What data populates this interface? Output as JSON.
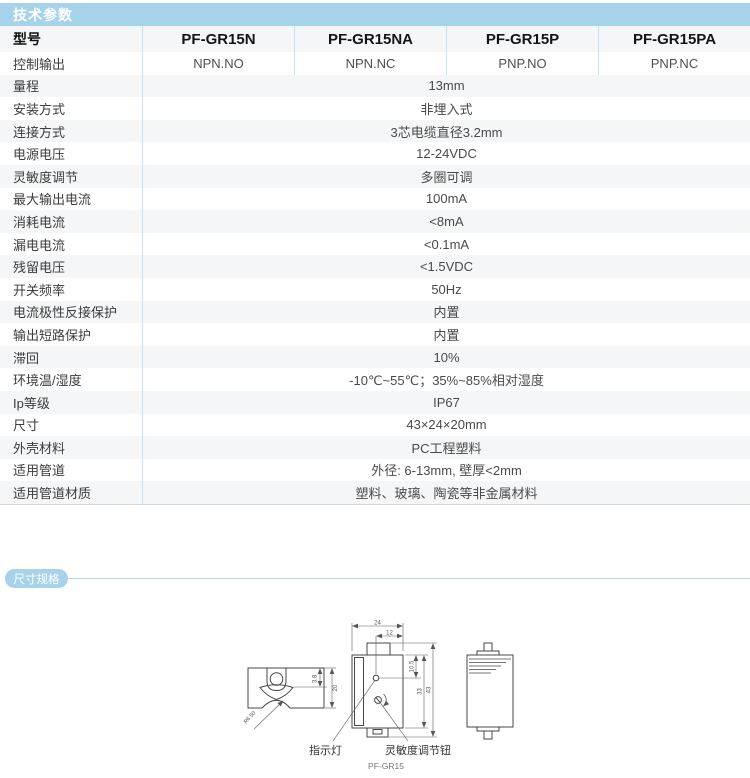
{
  "colors": {
    "accent_blue": "#a6d3e9",
    "divider_blue": "#c9e2f2",
    "stripe_gray": "#f5f6f7"
  },
  "tech": {
    "section_title": "技术参数",
    "model_label": "型号",
    "models": [
      "PF-GR15N",
      "PF-GR15NA",
      "PF-GR15P",
      "PF-GR15PA"
    ],
    "output_row": {
      "label": "控制输出",
      "values": [
        "NPN.NO",
        "NPN.NC",
        "PNP.NO",
        "PNP.NC"
      ]
    },
    "rows": [
      {
        "label": "量程",
        "value": "13mm"
      },
      {
        "label": "安装方式",
        "value": "非埋入式"
      },
      {
        "label": "连接方式",
        "value": "3芯电缆直径3.2mm"
      },
      {
        "label": "电源电压",
        "value": "12-24VDC"
      },
      {
        "label": "灵敏度调节",
        "value": "多圈可调"
      },
      {
        "label": "最大输出电流",
        "value": "100mA"
      },
      {
        "label": "消耗电流",
        "value": "<8mA"
      },
      {
        "label": "漏电电流",
        "value": "<0.1mA"
      },
      {
        "label": "残留电压",
        "value": "<1.5VDC"
      },
      {
        "label": "开关频率",
        "value": "50Hz"
      },
      {
        "label": "电流极性反接保护",
        "value": "内置"
      },
      {
        "label": "输出短路保护",
        "value": "内置"
      },
      {
        "label": "滞回",
        "value": "10%"
      },
      {
        "label": "环境温/湿度",
        "value": "-10℃~55℃；35%~85%相对湿度"
      },
      {
        "label": "Ip等级",
        "value": "IP67"
      },
      {
        "label": "尺寸",
        "value": "43×24×20mm"
      },
      {
        "label": "外壳材料",
        "value": "PC工程塑料"
      },
      {
        "label": "适用管道",
        "value": "外径: 6-13mm, 壁厚<2mm"
      },
      {
        "label": "适用管道材质",
        "value": "塑料、玻璃、陶瓷等非金属材料"
      }
    ]
  },
  "dims_section": {
    "title": "尺寸规格",
    "caption": "PF-GR15",
    "callouts": {
      "indicator_light": "指示灯",
      "sensitivity_knob": "灵敏度调节钮"
    },
    "measurements": {
      "overall_width": "24",
      "center_offset": "12",
      "led_offset": "10.5",
      "body_height": "33",
      "overall_height": "43",
      "slot_depth": "3.8",
      "clamp_height": "20",
      "saddle_radius": "R6.50"
    }
  }
}
